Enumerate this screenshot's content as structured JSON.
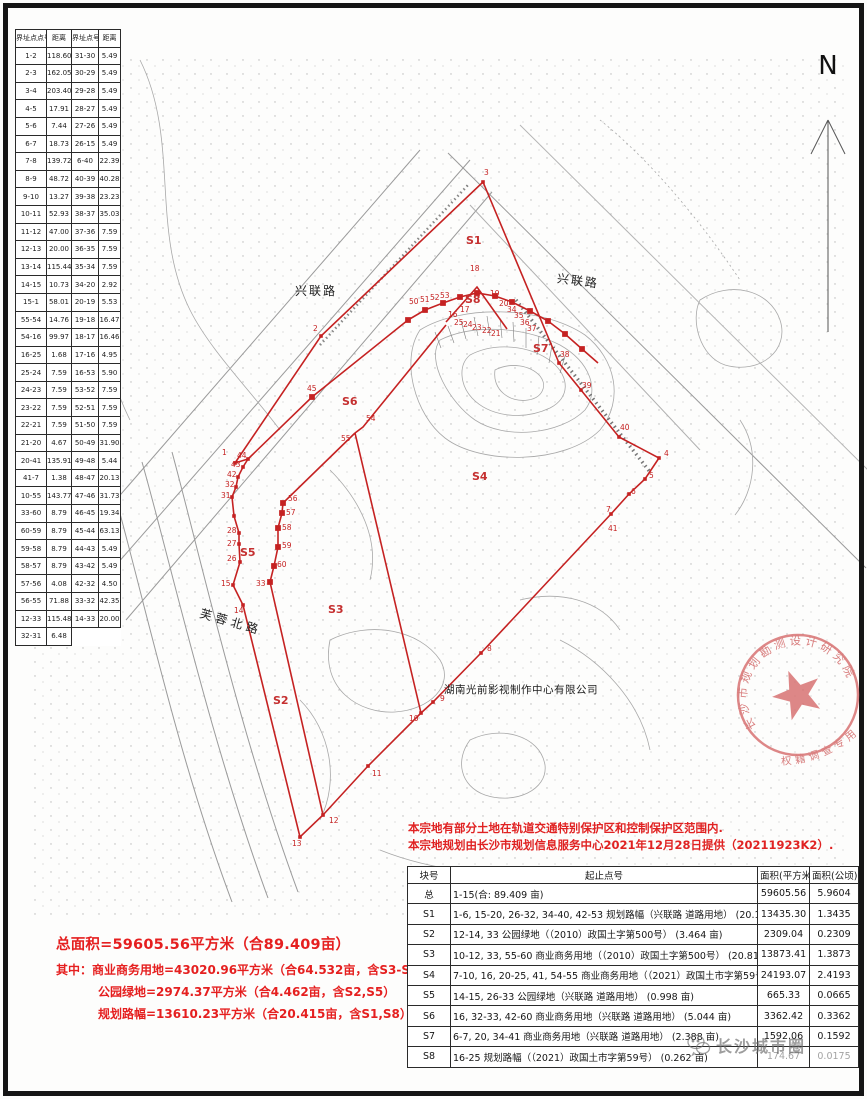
{
  "north": {
    "label": "N"
  },
  "boundary_table": {
    "headers": [
      "界址点点号",
      "距离",
      "界址点号",
      "距离"
    ],
    "rows": [
      [
        "1-2",
        "118.60",
        "31-30",
        "5.49"
      ],
      [
        "2-3",
        "162.05",
        "30-29",
        "5.49"
      ],
      [
        "3-4",
        "203.40",
        "29-28",
        "5.49"
      ],
      [
        "4-5",
        "17.91",
        "28-27",
        "5.49"
      ],
      [
        "5-6",
        "7.44",
        "27-26",
        "5.49"
      ],
      [
        "6-7",
        "18.73",
        "26-15",
        "5.49"
      ],
      [
        "7-8",
        "139.72",
        "6-40",
        "22.39"
      ],
      [
        "8-9",
        "48.72",
        "40-39",
        "40.28"
      ],
      [
        "9-10",
        "13.27",
        "39-38",
        "23.23"
      ],
      [
        "10-11",
        "52.93",
        "38-37",
        "35.03"
      ],
      [
        "11-12",
        "47.00",
        "37-36",
        "7.59"
      ],
      [
        "12-13",
        "20.00",
        "36-35",
        "7.59"
      ],
      [
        "13-14",
        "115.44",
        "35-34",
        "7.59"
      ],
      [
        "14-15",
        "10.73",
        "34-20",
        "2.92"
      ],
      [
        "15-1",
        "58.01",
        "20-19",
        "5.53"
      ],
      [
        "55-54",
        "14.76",
        "19-18",
        "16.47"
      ],
      [
        "54-16",
        "99.97",
        "18-17",
        "16.46"
      ],
      [
        "16-25",
        "1.68",
        "17-16",
        "4.95"
      ],
      [
        "25-24",
        "7.59",
        "16-53",
        "5.90"
      ],
      [
        "24-23",
        "7.59",
        "53-52",
        "7.59"
      ],
      [
        "23-22",
        "7.59",
        "52-51",
        "7.59"
      ],
      [
        "22-21",
        "7.59",
        "51-50",
        "7.59"
      ],
      [
        "21-20",
        "4.67",
        "50-49",
        "31.90"
      ],
      [
        "20-41",
        "135.91",
        "49-48",
        "5.44"
      ],
      [
        "41-7",
        "1.38",
        "48-47",
        "20.13"
      ],
      [
        "10-55",
        "143.77",
        "47-46",
        "31.73"
      ],
      [
        "33-60",
        "8.79",
        "46-45",
        "19.34"
      ],
      [
        "60-59",
        "8.79",
        "45-44",
        "63.13"
      ],
      [
        "59-58",
        "8.79",
        "44-43",
        "5.49"
      ],
      [
        "58-57",
        "8.79",
        "43-42",
        "5.49"
      ],
      [
        "57-56",
        "4.08",
        "42-32",
        "4.50"
      ],
      [
        "56-55",
        "71.88",
        "33-32",
        "42.35"
      ],
      [
        "12-33",
        "115.48",
        "14-33",
        "20.00"
      ],
      [
        "32-31",
        "6.48",
        "",
        ""
      ]
    ]
  },
  "map": {
    "road_labels": {
      "xinglian_left": "兴联路",
      "xinglian_right": "兴联路",
      "furong_north": "芙蓉北路"
    },
    "company": "湖南光前影视制作中心有限公司",
    "parcels": [
      {
        "t": "S1",
        "x": 466,
        "y": 244
      },
      {
        "t": "S2",
        "x": 273,
        "y": 704
      },
      {
        "t": "S3",
        "x": 328,
        "y": 613
      },
      {
        "t": "S4",
        "x": 472,
        "y": 480
      },
      {
        "t": "S5",
        "x": 240,
        "y": 556
      },
      {
        "t": "S6",
        "x": 342,
        "y": 405
      },
      {
        "t": "S7",
        "x": 533,
        "y": 352
      },
      {
        "t": "S8",
        "x": 465,
        "y": 303
      }
    ],
    "points": [
      {
        "t": "1",
        "x": 222,
        "y": 455
      },
      {
        "t": "2",
        "x": 313,
        "y": 331
      },
      {
        "t": "3",
        "x": 484,
        "y": 175
      },
      {
        "t": "4",
        "x": 664,
        "y": 456
      },
      {
        "t": "5",
        "x": 649,
        "y": 478
      },
      {
        "t": "6",
        "x": 631,
        "y": 494
      },
      {
        "t": "7",
        "x": 606,
        "y": 512
      },
      {
        "t": "8",
        "x": 487,
        "y": 651
      },
      {
        "t": "9",
        "x": 440,
        "y": 701
      },
      {
        "t": "10",
        "x": 409,
        "y": 721
      },
      {
        "t": "11",
        "x": 372,
        "y": 776
      },
      {
        "t": "12",
        "x": 329,
        "y": 823
      },
      {
        "t": "13",
        "x": 292,
        "y": 846
      },
      {
        "t": "14",
        "x": 234,
        "y": 613
      },
      {
        "t": "15",
        "x": 221,
        "y": 586
      },
      {
        "t": "16",
        "x": 448,
        "y": 317
      },
      {
        "t": "17",
        "x": 460,
        "y": 312
      },
      {
        "t": "18",
        "x": 470,
        "y": 271
      },
      {
        "t": "19",
        "x": 490,
        "y": 296
      },
      {
        "t": "20",
        "x": 499,
        "y": 306
      },
      {
        "t": "21",
        "x": 491,
        "y": 336
      },
      {
        "t": "22",
        "x": 482,
        "y": 333
      },
      {
        "t": "23",
        "x": 472,
        "y": 330
      },
      {
        "t": "24",
        "x": 463,
        "y": 327
      },
      {
        "t": "25",
        "x": 454,
        "y": 325
      },
      {
        "t": "26",
        "x": 227,
        "y": 561
      },
      {
        "t": "27",
        "x": 227,
        "y": 546
      },
      {
        "t": "28",
        "x": 227,
        "y": 533
      },
      {
        "t": "31",
        "x": 221,
        "y": 498
      },
      {
        "t": "32",
        "x": 225,
        "y": 487
      },
      {
        "t": "33",
        "x": 256,
        "y": 586
      },
      {
        "t": "34",
        "x": 507,
        "y": 312
      },
      {
        "t": "35",
        "x": 514,
        "y": 318
      },
      {
        "t": "36",
        "x": 520,
        "y": 325
      },
      {
        "t": "37",
        "x": 527,
        "y": 331
      },
      {
        "t": "38",
        "x": 560,
        "y": 357
      },
      {
        "t": "39",
        "x": 582,
        "y": 388
      },
      {
        "t": "40",
        "x": 620,
        "y": 430
      },
      {
        "t": "41",
        "x": 608,
        "y": 531
      },
      {
        "t": "42",
        "x": 227,
        "y": 477
      },
      {
        "t": "43",
        "x": 231,
        "y": 467
      },
      {
        "t": "44",
        "x": 237,
        "y": 458
      },
      {
        "t": "45",
        "x": 307,
        "y": 391
      },
      {
        "t": "50",
        "x": 409,
        "y": 304
      },
      {
        "t": "51",
        "x": 420,
        "y": 302
      },
      {
        "t": "52",
        "x": 430,
        "y": 300
      },
      {
        "t": "53",
        "x": 440,
        "y": 298
      },
      {
        "t": "54",
        "x": 366,
        "y": 421
      },
      {
        "t": "55",
        "x": 341,
        "y": 441
      },
      {
        "t": "56",
        "x": 288,
        "y": 501
      },
      {
        "t": "57",
        "x": 286,
        "y": 515
      },
      {
        "t": "58",
        "x": 282,
        "y": 530
      },
      {
        "t": "59",
        "x": 282,
        "y": 548
      },
      {
        "t": "60",
        "x": 277,
        "y": 567
      }
    ],
    "boundary_color": "#c52222"
  },
  "stamp": {
    "top_text": "长沙市规划勘测设计研究院",
    "bottom_text": "权籍调查专用章",
    "color": "#d66a6a"
  },
  "notes": {
    "line1": "本宗地有部分土地在轨道交通特别保护区和控制保护区范围内.",
    "line2": "本宗地规划由长沙市规划信息服务中心2021年12月28日提供（20211923K2）."
  },
  "summary": {
    "line1": "总面积=59605.56平方米（合89.409亩）",
    "line2": "其中：商业商务用地=43020.96平方米（合64.532亩，含S3-S4,S6-S7）",
    "line3": "公园绿地=2974.37平方米（合4.462亩，含S2,S5）",
    "line4": "规划路幅=13610.23平方米（合20.415亩，含S1,S8）"
  },
  "area_table": {
    "headers": [
      "块号",
      "起止点号",
      "面积(平方米)",
      "面积(公顷)"
    ],
    "rows": [
      [
        "总",
        "1-15(合: 89.409 亩)",
        "59605.56",
        "5.9604"
      ],
      [
        "S1",
        "1-6, 15-20, 26-32, 34-40, 42-53   规划路幅（兴联路 道路用地） (20.153 亩)",
        "13435.30",
        "1.3435"
      ],
      [
        "S2",
        "12-14, 33   公园绿地（（2010）政国土字第500号） (3.464 亩)",
        "2309.04",
        "0.2309"
      ],
      [
        "S3",
        "10-12, 33, 55-60   商业商务用地（（2010）政国土字第500号） (20.810 亩)",
        "13873.41",
        "1.3873"
      ],
      [
        "S4",
        "7-10, 16, 20-25, 41, 54-55   商业商务用地（（2021）政国土市字第59号） (36.290 亩)",
        "24193.07",
        "2.4193"
      ],
      [
        "S5",
        "14-15, 26-33   公园绿地（兴联路 道路用地） (0.998 亩)",
        "665.33",
        "0.0665"
      ],
      [
        "S6",
        "16, 32-33, 42-60   商业商务用地（兴联路 道路用地） (5.044 亩)",
        "3362.42",
        "0.3362"
      ],
      [
        "S7",
        "6-7, 20, 34-41   商业商务用地（兴联路 道路用地） (2.388 亩)",
        "1592.06",
        "0.1592"
      ],
      [
        "S8",
        "16-25   规划路幅（（2021）政国土市字第59号） (0.262 亩)",
        "174.67",
        "0.0175"
      ]
    ]
  },
  "watermark": {
    "text": "长沙城市圈"
  }
}
